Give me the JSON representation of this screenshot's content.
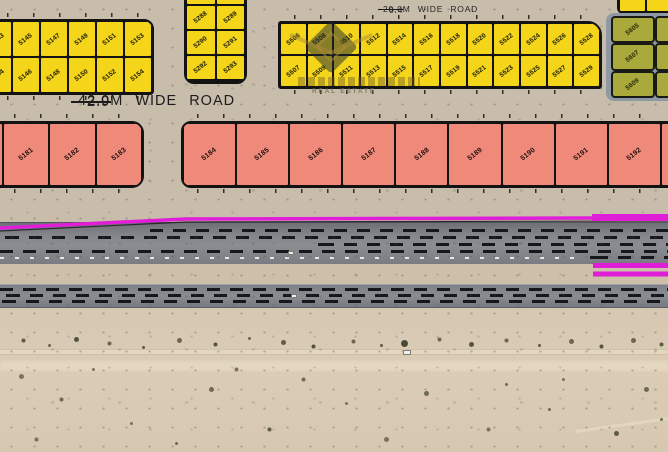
{
  "road_labels": {
    "top": {
      "text": "20.0M WIDE ROAD",
      "ghost": "0.4"
    },
    "middle": {
      "text": "42.0M WIDE ROAD",
      "ghost": "2.9"
    }
  },
  "watermark": {
    "subtitle": "REAL ESTATE"
  },
  "plots": {
    "yellow_left_row1": [
      "5143",
      "5145",
      "5147",
      "5149",
      "5151",
      "5153"
    ],
    "yellow_left_row2": [
      "5144",
      "5146",
      "5148",
      "5150",
      "5152",
      "5154"
    ],
    "yellow_mid": [
      "",
      "",
      "5288",
      "5289",
      "5290",
      "5291",
      "5292",
      "5293"
    ],
    "yellow_right_row1": [
      "5506",
      "5508",
      "5510",
      "5512",
      "5514",
      "5516",
      "5518",
      "5520",
      "5522",
      "5524",
      "5526",
      "5528"
    ],
    "yellow_right_row2": [
      "5507",
      "5509",
      "5511",
      "5513",
      "5515",
      "5517",
      "5519",
      "5521",
      "5523",
      "5525",
      "5527",
      "5529"
    ],
    "yellow_stub": [
      "",
      ""
    ],
    "green": [
      "5605",
      "",
      "5607",
      "",
      "5609",
      ""
    ],
    "pink_left": [
      "",
      "5181",
      "5182",
      "5183"
    ],
    "pink_right": [
      "5184",
      "5185",
      "5186",
      "5187",
      "5188",
      "5189",
      "5190",
      "5191",
      "5192",
      ""
    ]
  },
  "colors": {
    "plot_yellow": "#f4d51a",
    "plot_pink": "#ef8a7b",
    "plot_green": "#a9aa3b",
    "plot_border": "#131313",
    "magenta": "#e01ed8",
    "road_gray": "#84868c",
    "sand": "#c8bcab",
    "green_backdrop": "#8e99a3"
  }
}
